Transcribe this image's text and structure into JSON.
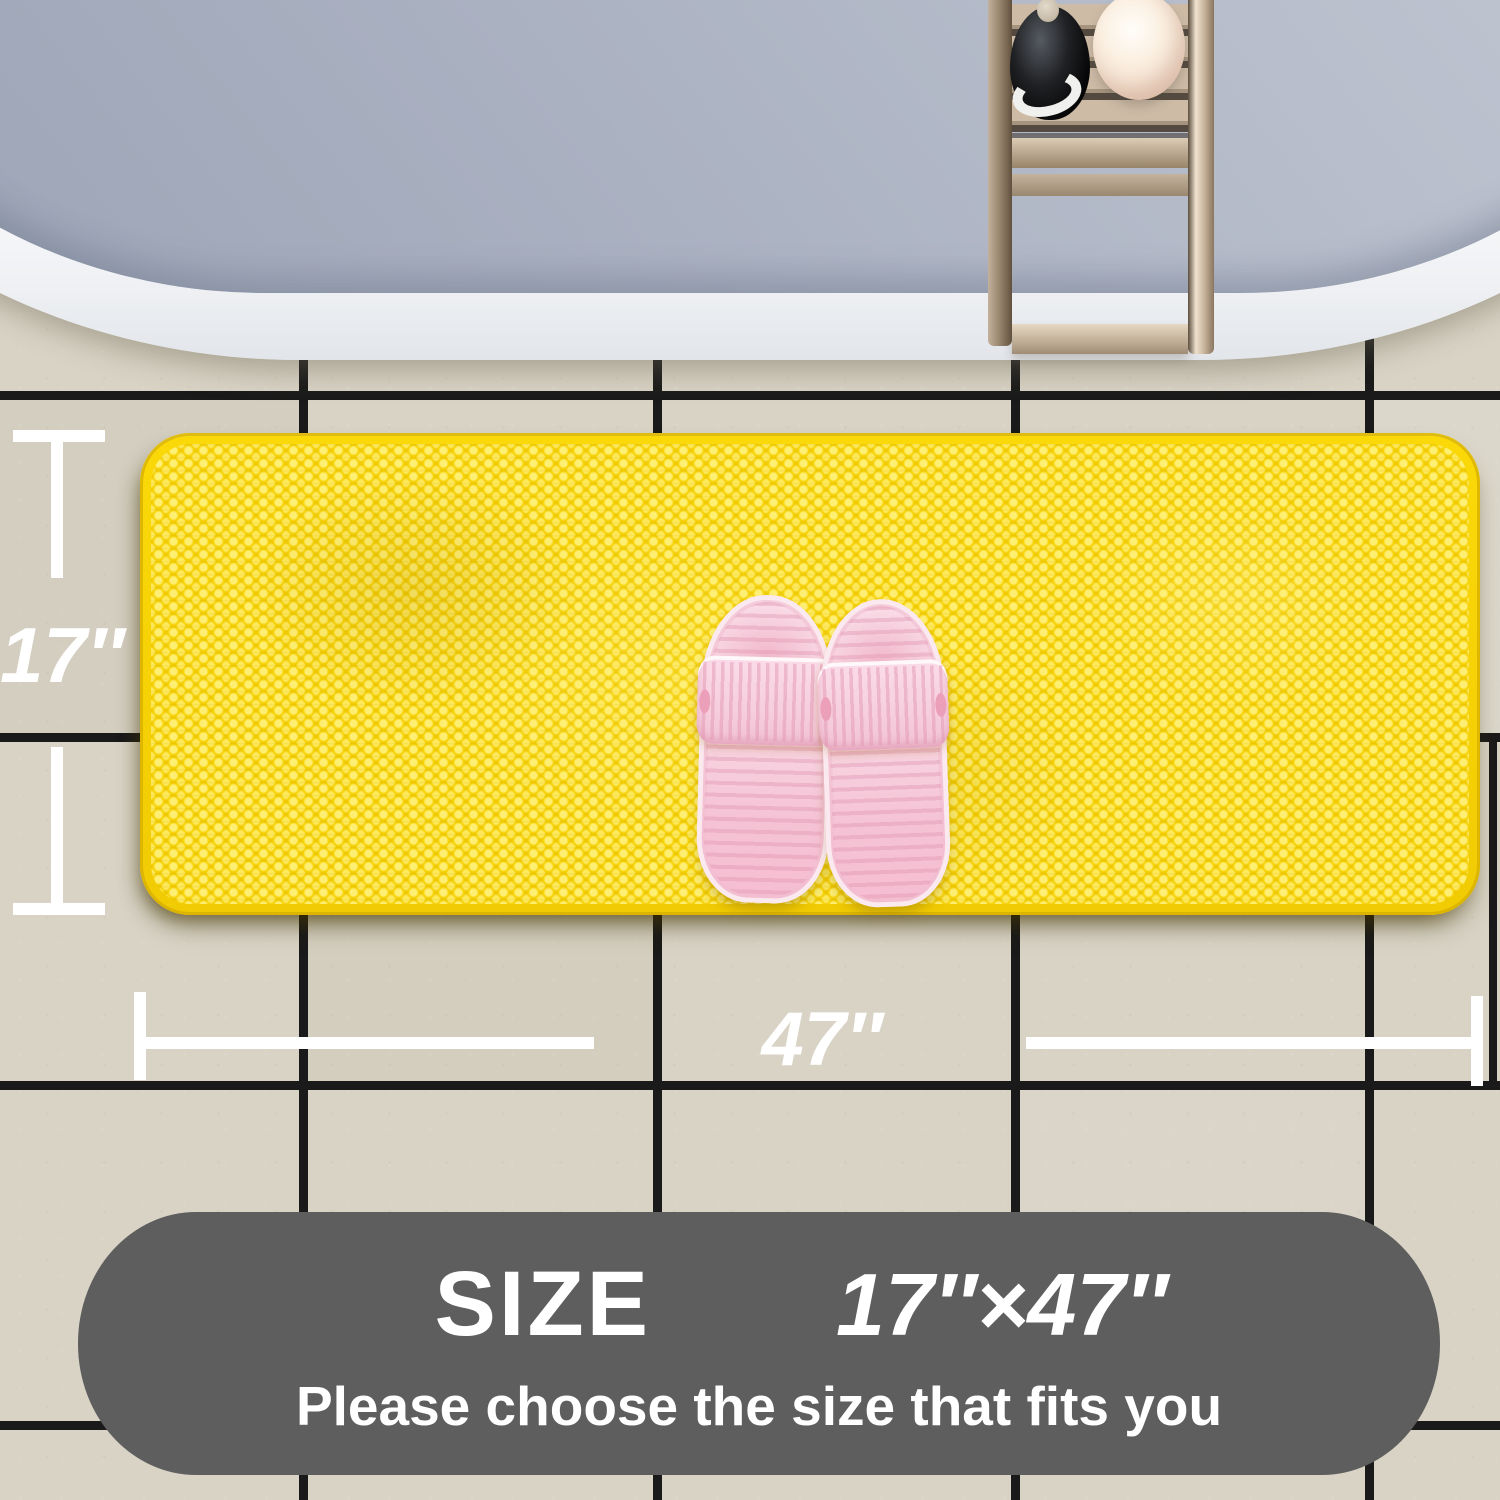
{
  "dimensions": {
    "height_label": "17″",
    "width_label": "47″",
    "line_color": "#ffffff"
  },
  "banner": {
    "size_title": "SIZE",
    "size_value": "17″×47″",
    "subtitle": "Please choose the size that fits you",
    "bg_color": "#5e5e5e",
    "text_color": "#ffffff"
  },
  "scene": {
    "tile_color": "#d8d3c5",
    "grout_color": "#1a1a1a",
    "tub_rim_color": "#ffffff",
    "water_color": "#b0b7c6",
    "caddy_wood_color": "#c9b8a4",
    "bottle_dark_color": "#101012",
    "bath_ball_color": "#f8ead9",
    "mat_color": "#f4cf03",
    "mat_pile_highlight": "#ffe763",
    "mat_edge_color": "#e3bd00",
    "slipper_color": "#f8d6e2"
  }
}
